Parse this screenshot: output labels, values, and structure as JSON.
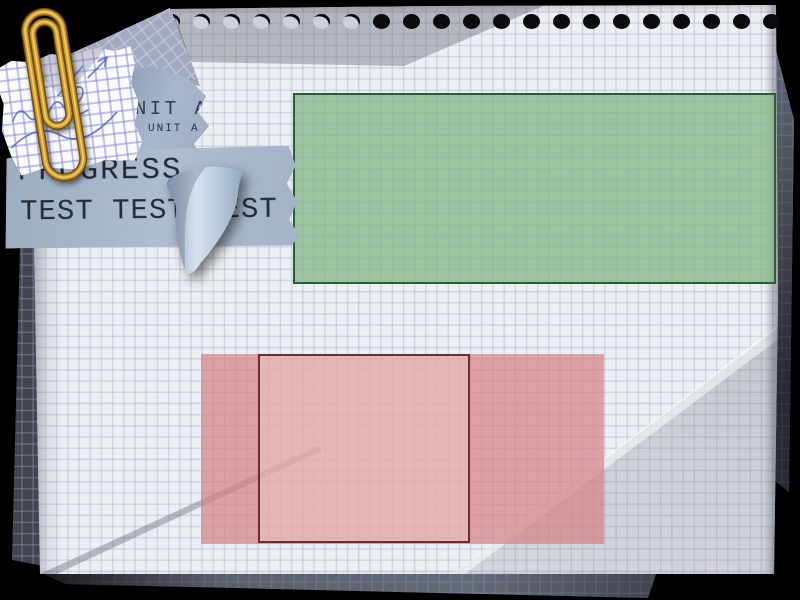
{
  "canvas": {
    "background": "#000000",
    "width": 800,
    "height": 600
  },
  "notebook": {
    "holes": 21,
    "crescent_holes": 7,
    "paper_color": "#edf0f3",
    "grid_color": "#a5b0d0"
  },
  "labels": {
    "unit_a_large": "UNIT A",
    "unit_a_small": "UNIT A",
    "progress": "PROGRESS",
    "test_line": "TEST TEST TEST"
  },
  "shapes": {
    "green_box": {
      "fill": "rgba(134,182,137,0.78)",
      "border": "#275f33"
    },
    "pink_box": {
      "fill": "rgba(214,130,133,0.72)"
    },
    "pink_inner_box": {
      "fill": "rgba(255,236,236,0.28)",
      "border": "#722b31"
    }
  },
  "decor": {
    "paperclip_color": "#cf9b2e",
    "scribble_color": "#4d5fc4",
    "scrap_paper_color": "#a6b7cc"
  }
}
